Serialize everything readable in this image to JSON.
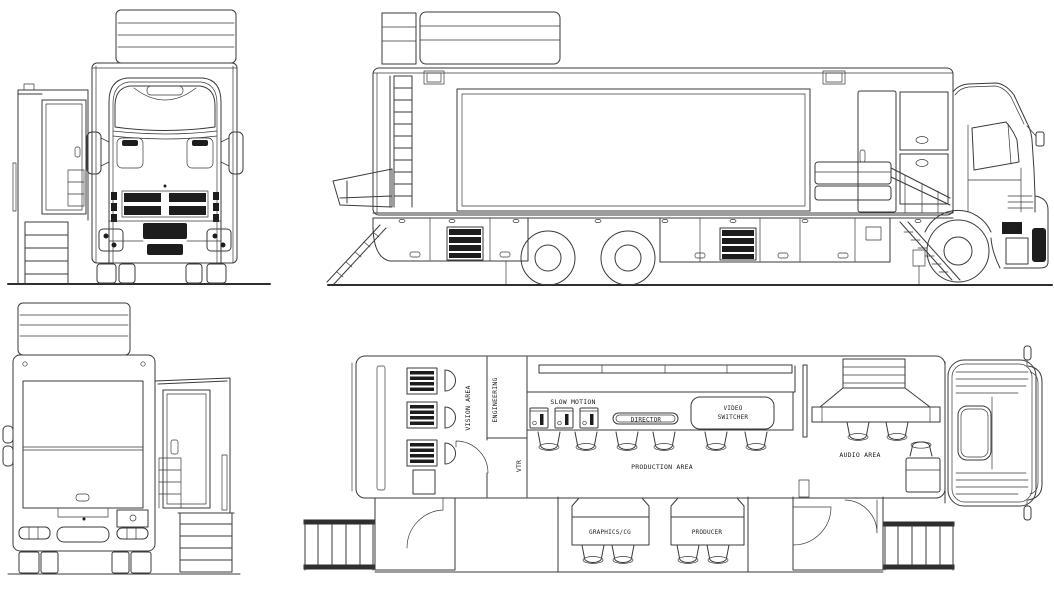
{
  "document": {
    "type": "outside-broadcast-truck-blueprint",
    "views": [
      "front view",
      "side view",
      "rear view",
      "floor plan"
    ]
  },
  "colors": {
    "background": "#ffffff",
    "line": "#3a3a3a",
    "dark_fill": "#1d1d1d",
    "text": "#1c1c1c"
  },
  "floor_plan_labels": {
    "vision_area": "VISION AREA",
    "engineering": "ENGINEERING",
    "vtr": "VTR",
    "slow_motion": "SLOW MOTION",
    "director": "DIRECTOR",
    "video_switcher": [
      "VIDEO",
      "SWITCHER"
    ],
    "production_area": "PRODUCTION AREA",
    "audio_area": "AUDIO AREA",
    "graphics_cg": "GRAPHICS/CG",
    "producer": "PRODUCER"
  }
}
